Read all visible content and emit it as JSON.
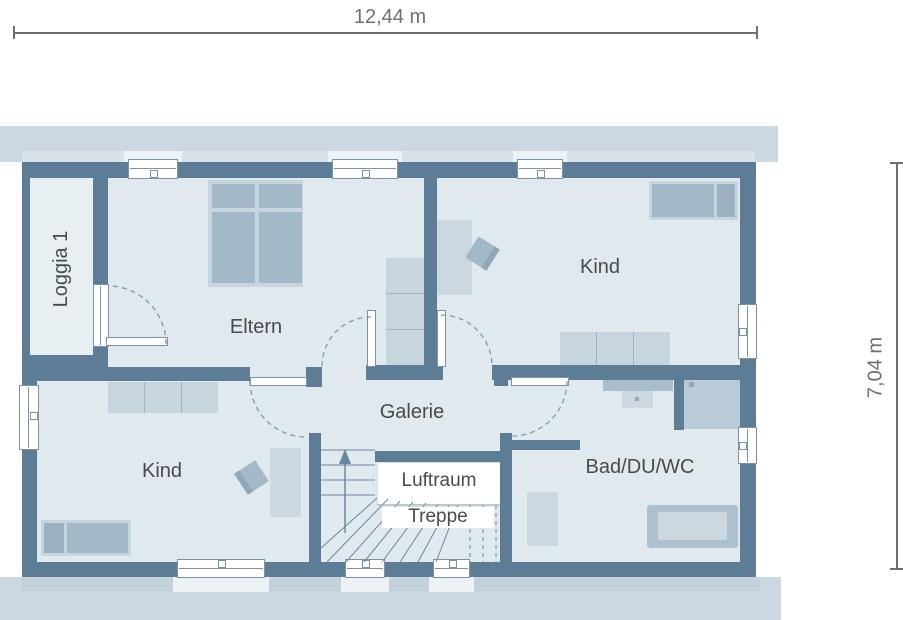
{
  "dimensions": {
    "width_label": "12,44 m",
    "height_label": "7,04 m"
  },
  "rooms": {
    "loggia": "Loggia 1",
    "eltern": "Eltern",
    "kind_top": "Kind",
    "kind_bottom": "Kind",
    "galerie": "Galerie",
    "luftraum": "Luftraum",
    "treppe": "Treppe",
    "bad": "Bad/DU/WC"
  },
  "colors": {
    "wall": "#5d7d97",
    "room_fill": "#dfe9ee",
    "loggia_fill": "#e7eff3",
    "roof_band": "#ccd8e1",
    "band_strip_top": "#d8e1e8",
    "band_strip_bottom": "#c2d1da",
    "sill": "#edf2f6",
    "furn_light": "#c7d5df",
    "furn_mid": "#a3b9c7",
    "furn_dark": "#9cb2c1",
    "fixture": "#ccd8e0",
    "fixture_mid": "#b9cbd6",
    "fixture_dark": "#adc0cd",
    "counter": "#a9bdca",
    "line": "#7d93a5",
    "dash": "#8296a6",
    "stair": "#6a87a0",
    "text": "#4a4a4a",
    "dim": "#6f6f6f"
  }
}
